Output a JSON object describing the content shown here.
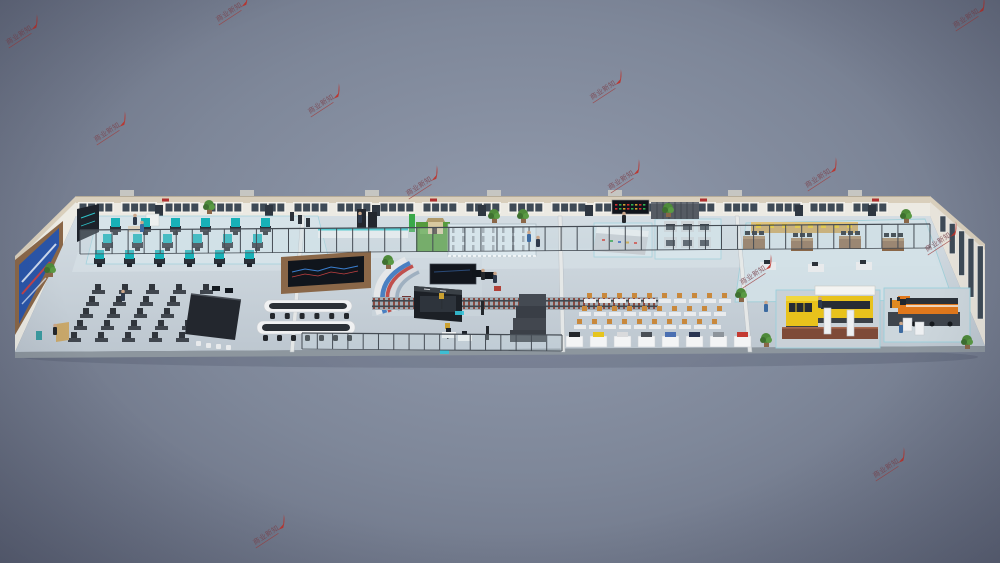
{
  "scene_label": "3D isometric render of rail-transit training center hall",
  "watermark": {
    "text": "商业新知",
    "text_color": "#7c4650",
    "underline_color": "#a04040",
    "accent_color": "#bf3028",
    "rotation": -33,
    "positions": [
      [
        8,
        45
      ],
      [
        218,
        22
      ],
      [
        955,
        28
      ],
      [
        96,
        142
      ],
      [
        310,
        114
      ],
      [
        592,
        100
      ],
      [
        408,
        196
      ],
      [
        610,
        190
      ],
      [
        807,
        188
      ],
      [
        742,
        285
      ],
      [
        927,
        252
      ],
      [
        255,
        545
      ],
      [
        875,
        478
      ]
    ]
  },
  "palette": {
    "wall_cream": "#d9cfbc",
    "wall_white": "#eceae3",
    "window_dark": "#3e4a56",
    "floor_back": "#d3dce2",
    "floor_front": "#bec8d1",
    "floor_edge": "#8d969e",
    "accent_fill": "#d7e5eb",
    "accent_border": "#9ad0dc",
    "corridor": "#d5dfe5",
    "glass_frame": "#454c54",
    "glass_pane": "rgba(200,220,228,0.28)",
    "teal_machine": "#17b1b7",
    "dark_obj": "#23272e",
    "wood": "#8a6748",
    "screen_blue": "#2a55a8",
    "screen_dark": "#10151c",
    "console_white": "#f0f1f2",
    "desk_dark": "#40464e",
    "chair_dark": "#30353c",
    "desk_light": "#e9ebed",
    "chair_orange": "#c8883c",
    "grass": "#569b3d",
    "track_base": "#a2abb2",
    "sleeper": "#8a4a40",
    "rail": "#3f474e",
    "pedestal": "#f3f4f5",
    "vehicle_yellow": "#e8c21c",
    "vehicle_orange": "#e0781c",
    "platform_brick": "#7e4a38",
    "lift_white": "#eef0f2",
    "cabinet_gray": "#ced3d7",
    "plant_green": "#4e8a3a",
    "pot_brown": "#8a6748"
  },
  "back_wall": {
    "x0": 78,
    "x1": 930,
    "win_y": 202,
    "win_h": 11,
    "win_w": 36,
    "win_step": 43,
    "doors": [
      155,
      265,
      372,
      478,
      585,
      690,
      795,
      868
    ],
    "roof_units": [
      120,
      240,
      365,
      487,
      608,
      728,
      848
    ],
    "sign_marks": [
      162,
      430,
      700,
      872
    ]
  },
  "right_wall": {
    "win_count": 5
  },
  "glass_walls": [
    {
      "x0": 80,
      "y0": 254,
      "x1": 930,
      "y1": 248,
      "h": 24,
      "step": 16
    },
    {
      "x0": 302,
      "y0": 349,
      "x1": 562,
      "y1": 351,
      "h": 16,
      "step": 15
    }
  ],
  "dividers": [
    {
      "tx": 303,
      "bx": 292
    },
    {
      "tx": 560,
      "bx": 563
    },
    {
      "tx": 737,
      "bx": 750
    }
  ],
  "machines_teal": {
    "x": 110,
    "y": 218,
    "rows": 3,
    "cols": 6,
    "dx": 30,
    "dy": 16,
    "row_shift": -8
  },
  "classroom_left": {
    "x": 92,
    "y": 290,
    "rows": 5,
    "cols": 5,
    "dx": 27,
    "dy": 12,
    "row_shift": -6
  },
  "classroom_right": {
    "x": 584,
    "y": 299,
    "rows": 3,
    "cols": 10,
    "dx": 15,
    "dy": 13,
    "row_shift": -5
  },
  "substation": {
    "x": 452,
    "y": 227,
    "rows": 3,
    "cols": 8,
    "dx": 10,
    "dy": 9
  },
  "cabinets_grid": {
    "x": 664,
    "y": 221,
    "rows": 2,
    "cols": 3,
    "dx": 17,
    "dy": 16
  },
  "workbenches": {
    "positions": [
      [
        743,
        236
      ],
      [
        791,
        238
      ],
      [
        839,
        236
      ],
      [
        882,
        238
      ]
    ]
  },
  "bench_row": {
    "x": 751,
    "y": 222,
    "w": 107,
    "h": 11,
    "items": 8
  },
  "pedestals": {
    "x0": 566,
    "y": 336,
    "step": 24,
    "item_colors": [
      "#23262b",
      "#e6c51e",
      "#d9dadc",
      "#4a4f56",
      "#4a6fb2",
      "#2a3552",
      "#8d949b",
      "#c33a32"
    ]
  },
  "track": {
    "x0": 372,
    "x1": 658,
    "y": 297,
    "h": 13,
    "step": 5
  },
  "consoles": [
    {
      "x": 264,
      "y": 300,
      "w": 88,
      "h": 12,
      "chairs": 6
    },
    {
      "x": 257,
      "y": 321,
      "w": 98,
      "h": 13,
      "chairs": 7
    }
  ],
  "led_board": {
    "dot_colors": [
      "#d03030",
      "#30b050",
      "#d0a030",
      "#d03030",
      "#30b050",
      "#d0a030",
      "#d03030",
      "#30b050"
    ]
  },
  "people": [
    [
      140,
      229,
      1
    ],
    [
      358,
      220,
      0
    ],
    [
      481,
      277,
      2
    ],
    [
      493,
      280,
      0
    ],
    [
      527,
      239,
      1
    ],
    [
      536,
      244,
      0
    ],
    [
      622,
      220,
      2
    ],
    [
      121,
      298,
      0
    ],
    [
      53,
      332,
      2
    ],
    [
      764,
      309,
      1
    ],
    [
      818,
      305,
      0
    ],
    [
      899,
      330,
      1
    ],
    [
      133,
      222,
      0
    ]
  ],
  "person_colors": [
    "#2e3a4c",
    "#3c6aa0",
    "#23272b"
  ],
  "plants": [
    [
      209,
      209
    ],
    [
      388,
      264
    ],
    [
      494,
      218
    ],
    [
      668,
      212
    ],
    [
      741,
      297
    ],
    [
      50,
      272
    ],
    [
      967,
      344
    ],
    [
      766,
      342
    ],
    [
      523,
      218
    ],
    [
      906,
      218
    ]
  ]
}
